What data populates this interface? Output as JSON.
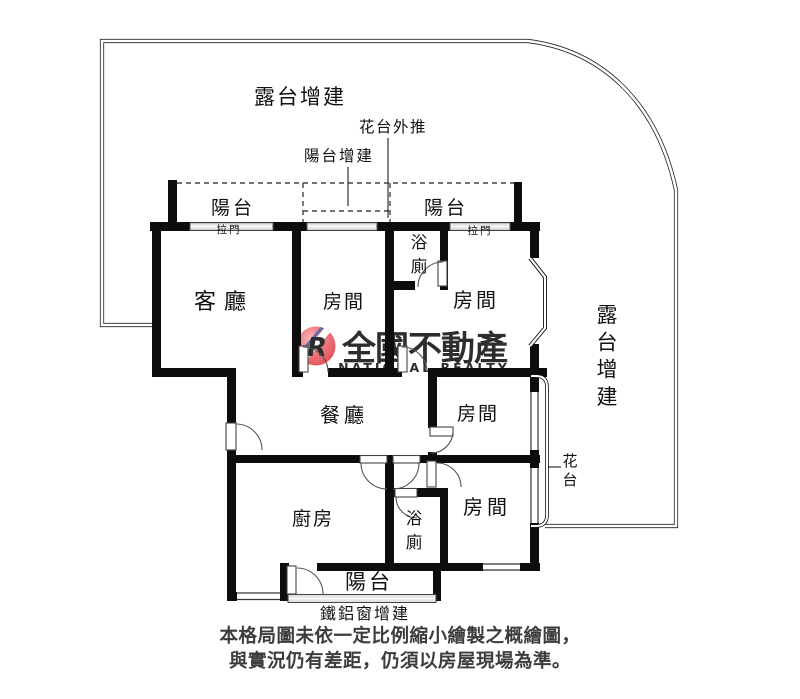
{
  "plan": {
    "terrace_top_label": "露台增建",
    "terrace_right_label": "露台增建",
    "flower_push_label": "花台外推",
    "balcony_addition_label": "陽台增建",
    "balcony_top_left_label": "陽台",
    "balcony_top_right_label": "陽台",
    "balcony_bottom_label": "陽台",
    "sliding_door_left_label": "拉門",
    "sliding_door_right_label": "拉門",
    "living_room_label": "客廳",
    "dining_room_label": "餐廳",
    "kitchen_label": "廚房",
    "bathroom_top_label": "浴廁",
    "bathroom_bottom_label": "浴廁",
    "bedroom_top_middle_label": "房間",
    "bedroom_top_right_label": "房間",
    "bedroom_middle_right_label": "房間",
    "bedroom_bottom_right_label": "房間",
    "flower_bed_label": "花台",
    "iron_window_label": "鐵鋁窗增建"
  },
  "watermark": {
    "logo_letter": "R",
    "brand_zh": "全國不動產",
    "brand_en": "NATIONAL REALTY",
    "brand_zh_color": "#e05052",
    "brand_en_color": "#f2a4a6",
    "logo_red": "#e6454d",
    "logo_yellow": "#ffe63e"
  },
  "disclaimer": {
    "line1": "本格局圖未依一定比例縮小繪製之概繪圖，",
    "line2": "與實況仍有差距，仍須以房屋現場為準。"
  },
  "colors": {
    "wall": "#0d0d0d",
    "thin_line": "#2b2b2b",
    "window_gray": "#e4e4e4"
  }
}
